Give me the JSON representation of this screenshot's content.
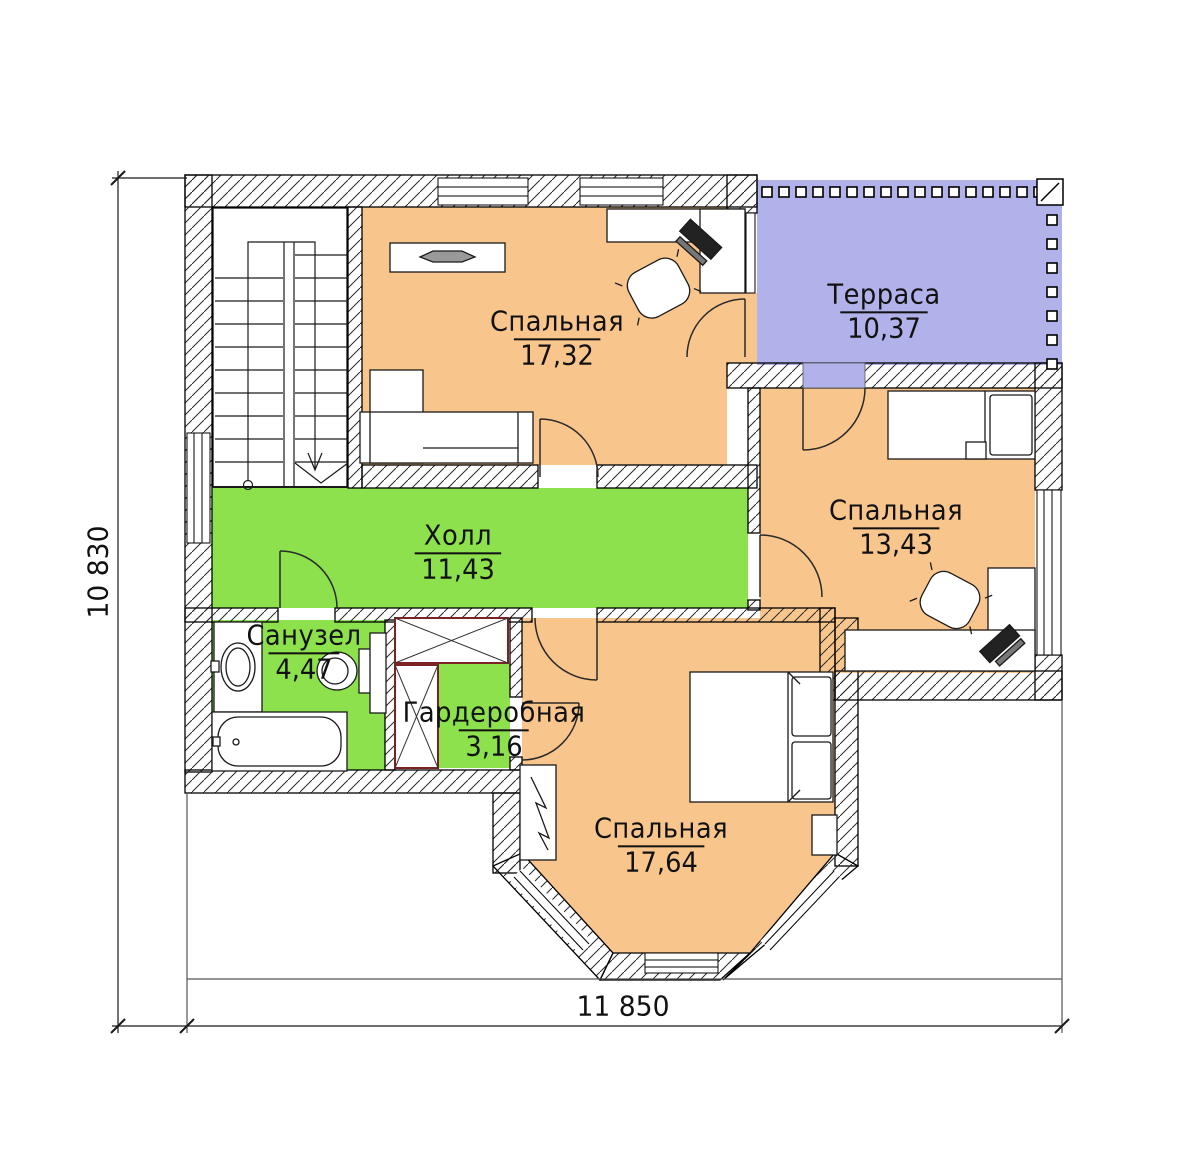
{
  "plan": {
    "type": "floor-plan",
    "language": "ru",
    "rooms": [
      {
        "id": "bedroom-1",
        "name": "Спальная",
        "area": "17,32",
        "fill": "bedroom"
      },
      {
        "id": "terrace",
        "name": "Терраса",
        "area": "10,37",
        "fill": "terrace"
      },
      {
        "id": "bedroom-2",
        "name": "Спальная",
        "area": "13,43",
        "fill": "bedroom"
      },
      {
        "id": "hall",
        "name": "Холл",
        "area": "11,43",
        "fill": "hall"
      },
      {
        "id": "bathroom",
        "name": "Санузел",
        "area": "4,47",
        "fill": "hall"
      },
      {
        "id": "wardrobe",
        "name": "Гардеробная",
        "area": "3,16",
        "fill": "hall"
      },
      {
        "id": "bedroom-3",
        "name": "Спальная",
        "area": "17,64",
        "fill": "bedroom"
      }
    ],
    "dimensions": {
      "width_label": "11 850",
      "height_label": "10 830"
    },
    "colors": {
      "bedroom": "#f8c68c",
      "terrace": "#b2b2eb",
      "hall": "#8ce14d",
      "closet_outline": "#7a2323",
      "line": "#1a1a1a"
    },
    "railing": {
      "top_posts": 17,
      "right_posts": 7
    }
  }
}
